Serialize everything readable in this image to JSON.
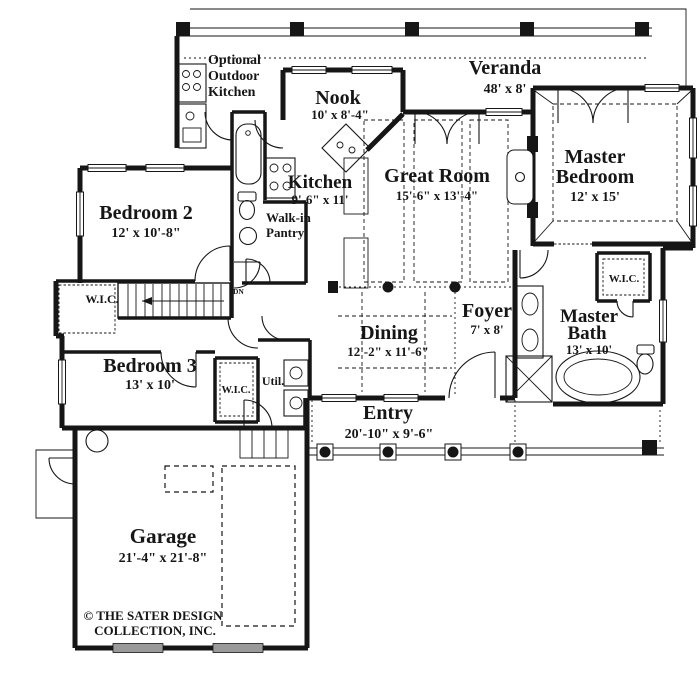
{
  "rooms": {
    "veranda": {
      "name": "Veranda",
      "dims": "48' x 8'"
    },
    "outdoor_kitchen": {
      "line1": "Optional",
      "line2": "Outdoor",
      "line3": "Kitchen"
    },
    "nook": {
      "name": "Nook",
      "dims": "10' x 8'-4\""
    },
    "master_bedroom": {
      "line1": "Master",
      "line2": "Bedroom",
      "dims": "12' x 15'"
    },
    "great_room": {
      "name": "Great Room",
      "dims": "15'-6\" x 13'-4\""
    },
    "kitchen": {
      "name": "Kitchen",
      "dims": "9'-6\" x 11'"
    },
    "pantry": {
      "line1": "Walk-in",
      "line2": "Pantry"
    },
    "bedroom2": {
      "name": "Bedroom 2",
      "dims": "12' x 10'-8\""
    },
    "wic_hall": {
      "name": "W.I.C."
    },
    "stairs": {
      "dn": "DN"
    },
    "dining": {
      "name": "Dining",
      "dims": "12'-2\" x 11'-6\""
    },
    "foyer": {
      "name": "Foyer",
      "dims": "7' x 8'"
    },
    "master_bath": {
      "line1": "Master",
      "line2": "Bath",
      "dims": "13' x 10'"
    },
    "wic_master": {
      "name": "W.I.C."
    },
    "bedroom3": {
      "name": "Bedroom 3",
      "dims": "13' x 10'"
    },
    "wic_bed3": {
      "name": "W.I.C."
    },
    "util": {
      "name": "Util."
    },
    "entry": {
      "name": "Entry",
      "dims": "20'-10\" x 9'-6\""
    },
    "garage": {
      "name": "Garage",
      "dims": "21'-4\" x 21'-8\""
    }
  },
  "footer": {
    "copyright_line1": "© THE SATER DESIGN",
    "copyright_line2": "COLLECTION, INC."
  },
  "colors": {
    "ink": "#161616",
    "paper": "#ffffff"
  }
}
